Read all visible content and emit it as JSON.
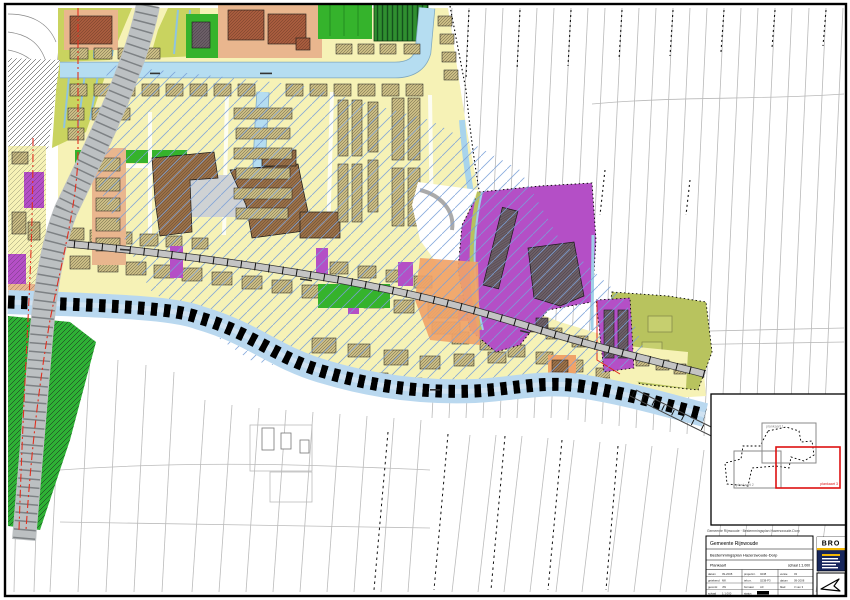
{
  "footer_note": "Gemeente Rijnwoude · Bestemmingsplan Hazerswoude-Dorp",
  "inset": {
    "sheet1": "plankaart 1",
    "sheet2": "plankaart 2",
    "sheet3": "plankaart 3"
  },
  "title_block": {
    "municipality": "Gemeente Rijnwoude",
    "plan_title": "Bestemmingsplan Hazerswoude-Dorp",
    "sheet_label": "Plankaart",
    "scale_label": "schaal 1:1.000",
    "logo_text": "BRO",
    "fields": [
      {
        "label": "datum",
        "value": "09-2008"
      },
      {
        "label": "getekend",
        "value": "MK"
      },
      {
        "label": "gecontr.",
        "value": "JW"
      },
      {
        "label": "schaal",
        "value": "1:1.000"
      },
      {
        "label": "projectnr.",
        "value": "0238"
      },
      {
        "label": "tek.nr.",
        "value": "0238-P3"
      },
      {
        "label": "formaat",
        "value": "A0"
      },
      {
        "label": "status",
        "value": "ontwerp"
      },
      {
        "label": "versie",
        "value": "03"
      },
      {
        "label": "datum",
        "value": "09-2008"
      },
      {
        "label": "blad",
        "value": "3 van 3"
      },
      {
        "label": "",
        "value": ""
      }
    ]
  },
  "palette": {
    "residential_yellow": "#f6f2b6",
    "water_blue": "#b5ddf1",
    "green": "#35b32c",
    "olive_field": "#c9d35f",
    "olive_zone": "#b8c35e",
    "purple": "#b44fc6",
    "orange": "#f0a368",
    "salmon": "#e9b68e",
    "brown_building": "#9a7048",
    "brick_building": "#a85c3e",
    "dark_building": "#6b5e66",
    "road_gray": "#c4c4c4",
    "boundary_red": "#e03020",
    "overlay_hatch_blue": "#7aa0d8",
    "logo_navy": "#16265c",
    "logo_yellow": "#f2b705"
  }
}
